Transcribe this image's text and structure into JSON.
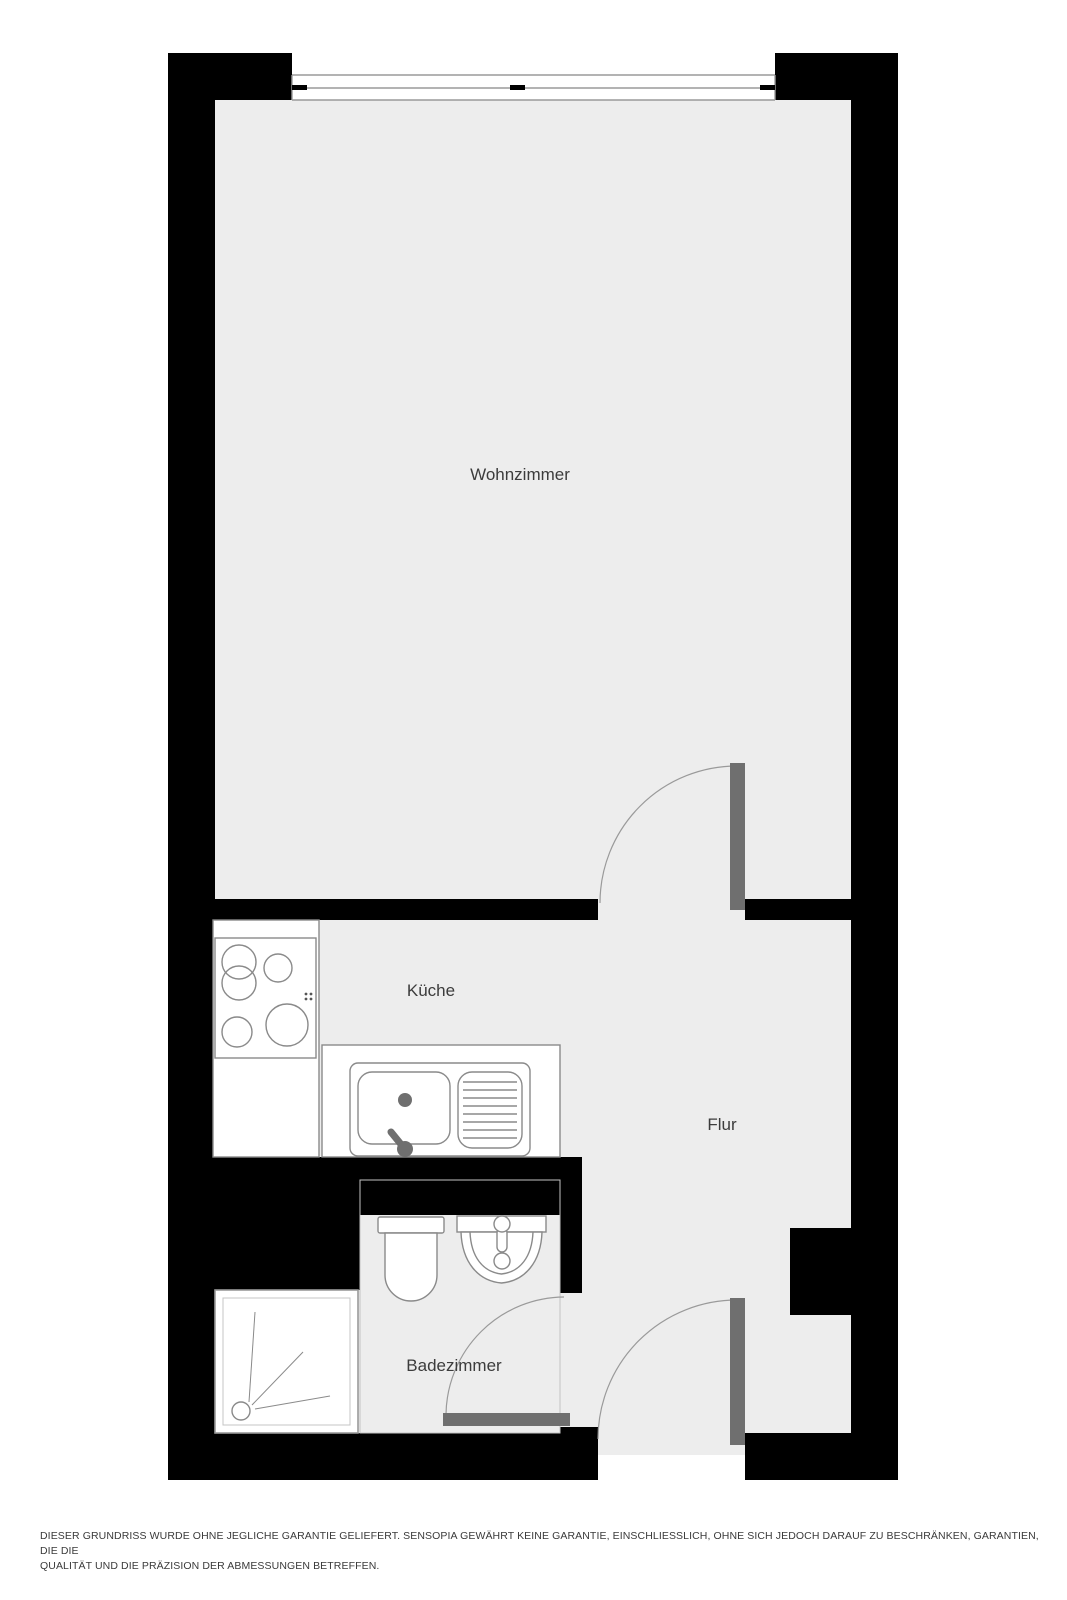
{
  "plan": {
    "type": "floor-plan",
    "rooms": {
      "wohnzimmer": {
        "label": "Wohnzimmer"
      },
      "kueche": {
        "label": "Küche"
      },
      "flur": {
        "label": "Flur"
      },
      "badezimmer": {
        "label": "Badezimmer"
      }
    },
    "fixtures": [
      "stove-icon",
      "kitchen-sink-icon",
      "toilet-icon",
      "washbasin-icon",
      "shower-icon",
      "window-icon",
      "door-swing-icon"
    ]
  },
  "footer": {
    "disclaimer_line1": "DIESER GRUNDRISS WURDE OHNE JEGLICHE GARANTIE GELIEFERT. SENSOPIA GEWÄHRT KEINE GARANTIE, EINSCHLIESSLICH, OHNE SICH JEDOCH DARAUF ZU BESCHRÄNKEN, GARANTIEN, DIE DIE",
    "disclaimer_line2": "QUALITÄT UND DIE PRÄZISION DER ABMESSUNGEN BETREFFEN."
  },
  "colors": {
    "background": "#ffffff",
    "wall": "#000000",
    "floor": "#ededed",
    "door-leaf": "#6f6f6f",
    "outline": "#9a9a9a",
    "fixture-stroke": "#8a8a8a",
    "label-text": "#3c3c3c",
    "disclaimer-text": "#3a3a3a"
  }
}
